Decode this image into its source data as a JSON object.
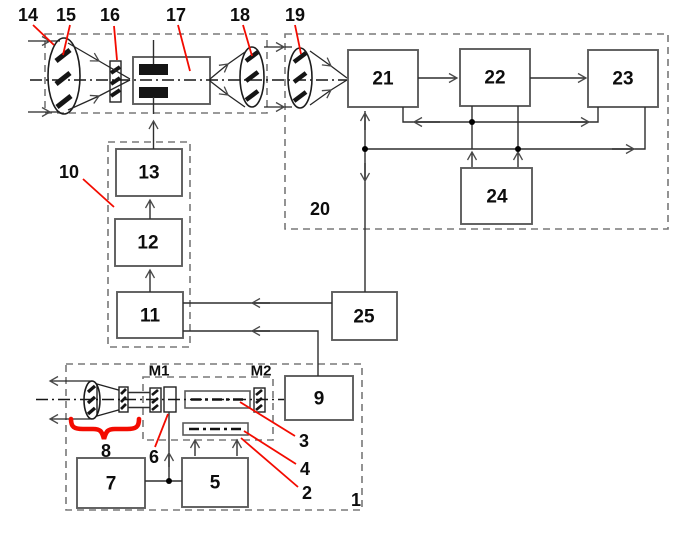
{
  "colors": {
    "accent_red": "#f30b00",
    "line": "#2e2e2e",
    "box_border": "#5c5c5c",
    "background": "#ffffff"
  },
  "callouts": {
    "c1": "1",
    "c2": "2",
    "c3": "3",
    "c4": "4",
    "c6": "6",
    "c8": "8",
    "c10": "10",
    "c14": "14",
    "c15": "15",
    "c16": "16",
    "c17": "17",
    "c18": "18",
    "c19": "19",
    "c20": "20"
  },
  "blocks": {
    "b5": "5",
    "b7": "7",
    "b9": "9",
    "b11": "11",
    "b12": "12",
    "b13": "13",
    "b21": "21",
    "b22": "22",
    "b23": "23",
    "b24": "24",
    "b25": "25"
  },
  "mirrors": {
    "m1": "M1",
    "m2": "M2"
  }
}
